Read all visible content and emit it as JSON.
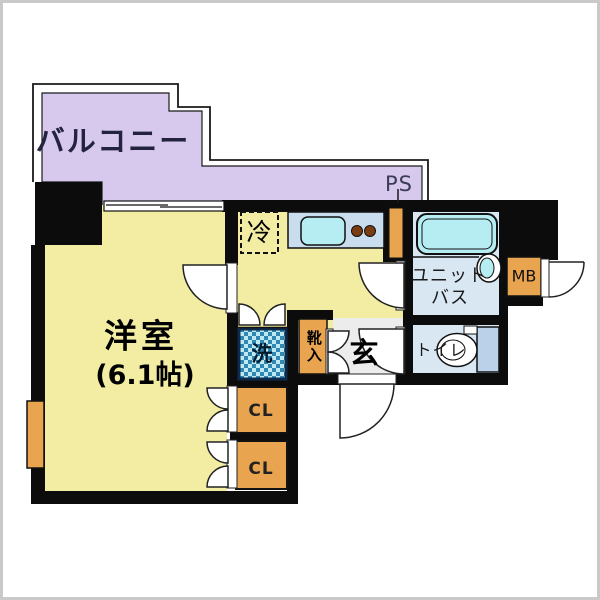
{
  "title": "apartment-floor-plan",
  "labels": {
    "balcony": "バルコニー",
    "pipe_space": "PS",
    "refrigerator": "冷",
    "room_name": "洋室",
    "room_size": "(6.1帖)",
    "unit_bath_line1": "ユニット",
    "unit_bath_line2": "バス",
    "meter_box": "MB",
    "toilet": "トイレ",
    "entrance": "玄",
    "shoe_cabinet": "靴入",
    "washer": "洗",
    "closet_upper": "CL",
    "closet_lower": "CL"
  },
  "colors": {
    "wall": "#0c0c0c",
    "balcony_fill": "#d7c9ee",
    "room_fill": "#f2eda3",
    "bath_fill": "#d9e7f3",
    "genkan_fill": "#ececec",
    "orange_fill": "#e9a44f",
    "counter_fill": "#c9ddef",
    "cyan_fill": "#b5edf3",
    "tank_fill": "#bad1e9",
    "burner_fill": "#7c3c12",
    "frame": "#c9c9c9"
  }
}
